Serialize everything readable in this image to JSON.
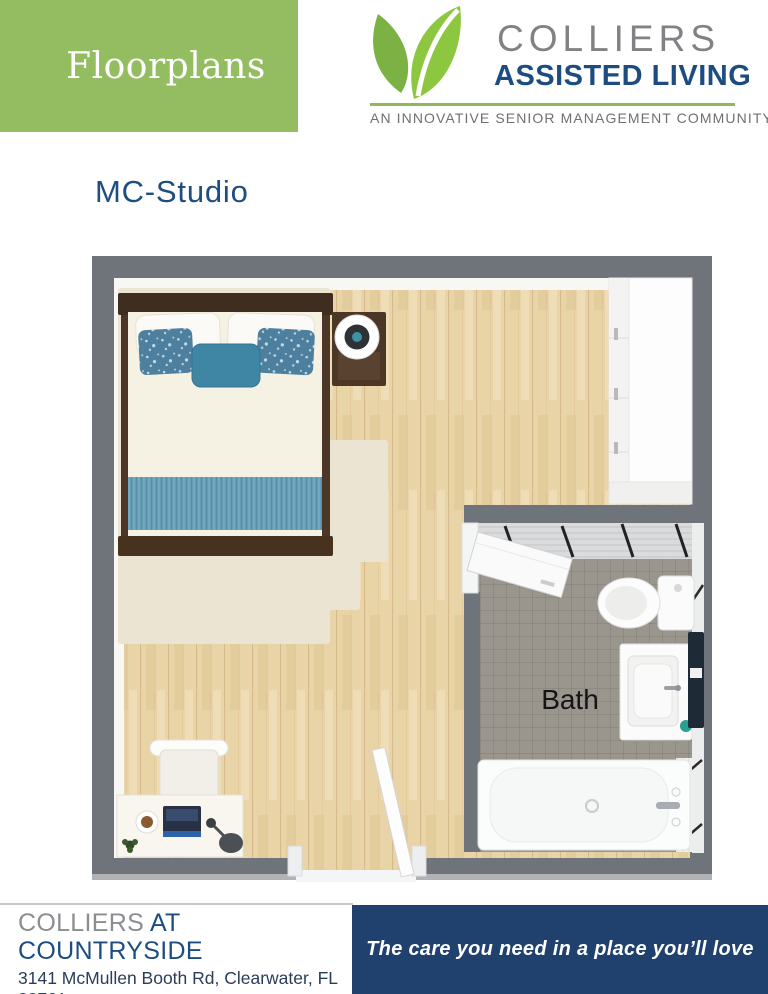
{
  "header": {
    "banner_label": "Floorplans",
    "logo": {
      "name": "COLLIERS",
      "subtitle": "ASSISTED LIVING",
      "tagline": "AN INNOVATIVE SENIOR MANAGEMENT COMMUNITY",
      "icon": "two-leaves-icon"
    }
  },
  "plan": {
    "title": "MC-Studio",
    "bath_label": "Bath"
  },
  "footer": {
    "community_primary": "COLLIERS",
    "community_secondary": "AT COUNTRYSIDE",
    "address": "3141 McMullen Booth Rd, Clearwater, FL 33761",
    "phone": "727-217-6449",
    "tagline": "The care you need in a place you’ll love"
  },
  "colors": {
    "banner_green": "#93bd60",
    "leaf_dark_green": "#7cb144",
    "leaf_light_green": "#8dc63f",
    "brand_navy": "#1d4d80",
    "footer_navy": "#20416e",
    "brand_gray": "#808285",
    "phone_green": "#94b457",
    "wall_gray": "#6f747a"
  }
}
